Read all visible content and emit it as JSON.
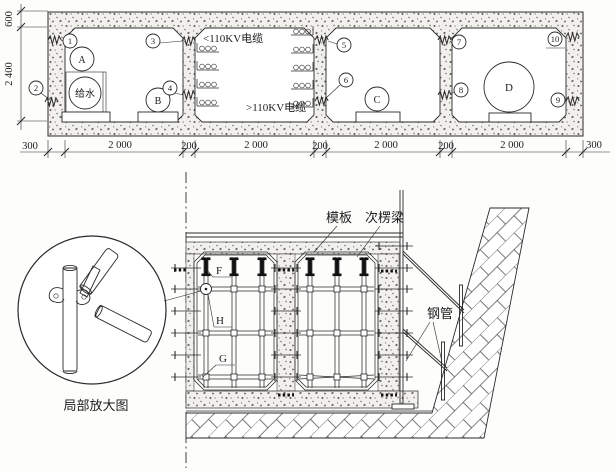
{
  "cross_section": {
    "dim_600": "600",
    "dim_2400": "2 400",
    "bottom_dims": [
      "300",
      "2 000",
      "200",
      "2 000",
      "200",
      "2 000",
      "200",
      "2 000",
      "300"
    ],
    "callouts": [
      "1",
      "2",
      "3",
      "4",
      "5",
      "6",
      "7",
      "8",
      "9",
      "10"
    ],
    "equipment": {
      "pipe_a": "A",
      "pipe_b": "B",
      "pipe_c": "C",
      "pipe_d": "D",
      "water_supply": "给水"
    },
    "cable_label_lt110kv": "<110KV电缆",
    "cable_label_gt110kv": ">110KV电缆"
  },
  "formwork_detail": {
    "label_formwork": "模板",
    "label_secondary_beam": "次楞梁",
    "label_steel_pipe": "钢管",
    "label_detail_view": "局部放大图",
    "label_f": "F",
    "label_g": "G",
    "label_h": "H"
  },
  "colors": {
    "line": "#2a2a2a",
    "concrete_fill": "#f2f0ec"
  }
}
